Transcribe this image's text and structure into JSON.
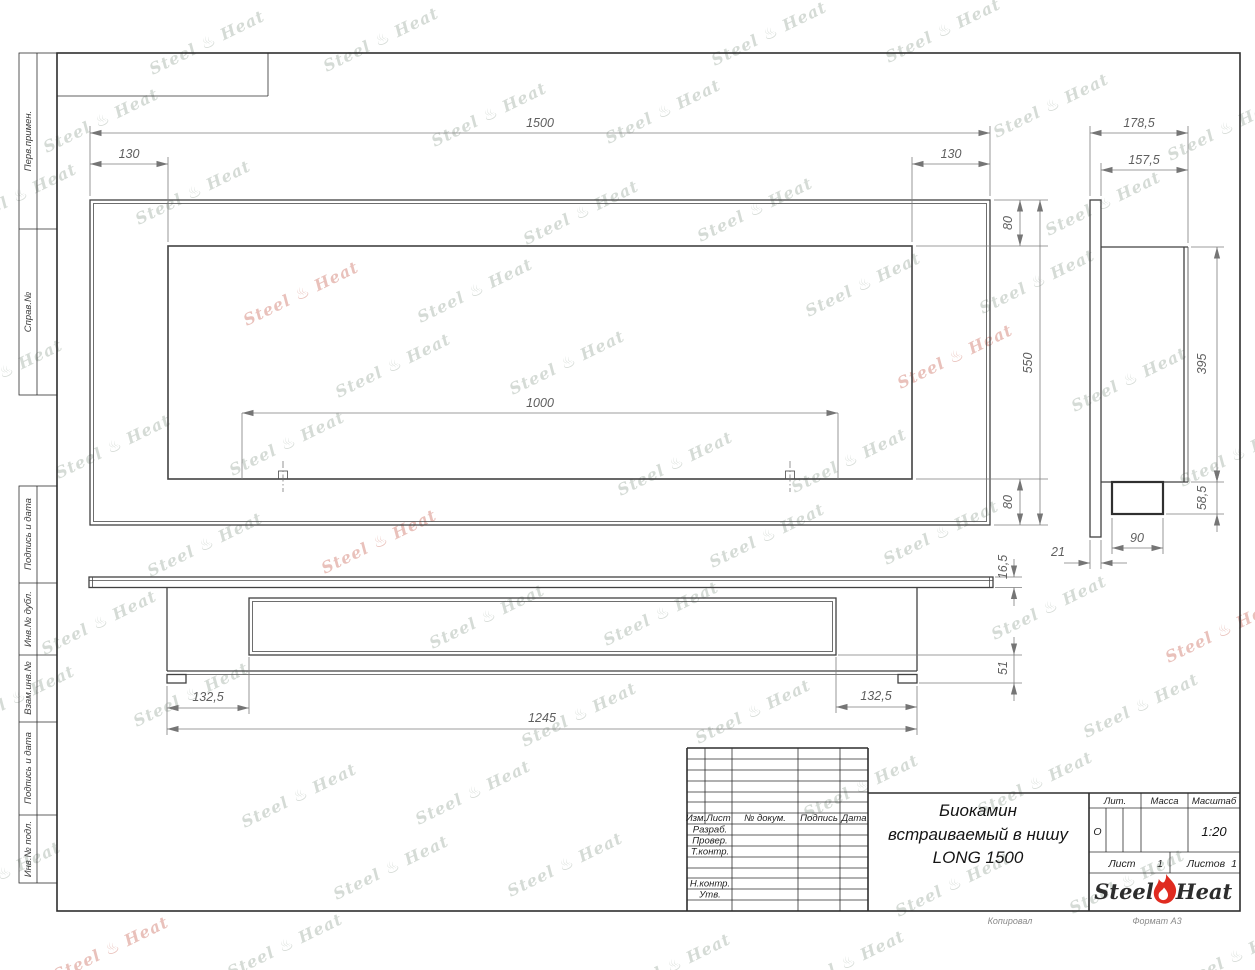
{
  "watermark": {
    "left": "Steel",
    "flame": "♨",
    "right": "Heat"
  },
  "sidebar_labels": {
    "perv_primen": "Перв.примен.",
    "sprav_no": "Справ.№",
    "podpis_data_1": "Подпись и дата",
    "inv_dubl": "Инв.№ дубл.",
    "vzam_inv": "Взам.инв.№",
    "podpis_data_2": "Подпись и дата",
    "inv_podl": "Инв.№ подл."
  },
  "front_view": {
    "dim_width": "1500",
    "dim_inset_left": "130",
    "dim_inset_right": "130",
    "dim_top": "80",
    "dim_height": "550",
    "dim_bottom": "80",
    "dim_burner": "1000"
  },
  "bottom_view": {
    "dim_flange": "16,5",
    "dim_base": "51",
    "dim_inset_left": "132,5",
    "dim_inset_right": "132,5",
    "dim_body": "1245"
  },
  "side_view": {
    "dim_depth": "178,5",
    "dim_body_depth": "157,5",
    "dim_body_height": "395",
    "dim_box_height": "58,5",
    "dim_box_width": "90",
    "dim_flange": "21"
  },
  "title_block": {
    "col_izm": "Изм.",
    "col_list": "Лист",
    "col_doc": "№ докум.",
    "col_podpis": "Подпись",
    "col_data": "Дата",
    "row_razrab": "Разраб.",
    "row_prover": "Провер.",
    "row_tkontr": "Т.контр.",
    "row_nkontr": "Н.контр.",
    "row_utv": "Утв.",
    "title_line1": "Биокамин",
    "title_line2": "встраиваемый в нишу",
    "title_line3": "LONG 1500",
    "lit_label": "Лит.",
    "lit_value": "О",
    "mass_label": "Масса",
    "scale_label": "Масштаб",
    "scale_value": "1:20",
    "sheet_label": "Лист",
    "sheet_value": "1",
    "sheets_label": "Листов",
    "sheets_value": "1",
    "logo_left": "Steel",
    "logo_right": "Heat",
    "footer_copied": "Копировал",
    "footer_format": "Формат А3"
  },
  "colors": {
    "accent_red": "#e02b20",
    "object_line": "#424242",
    "dim_line": "#7d7d7d"
  }
}
